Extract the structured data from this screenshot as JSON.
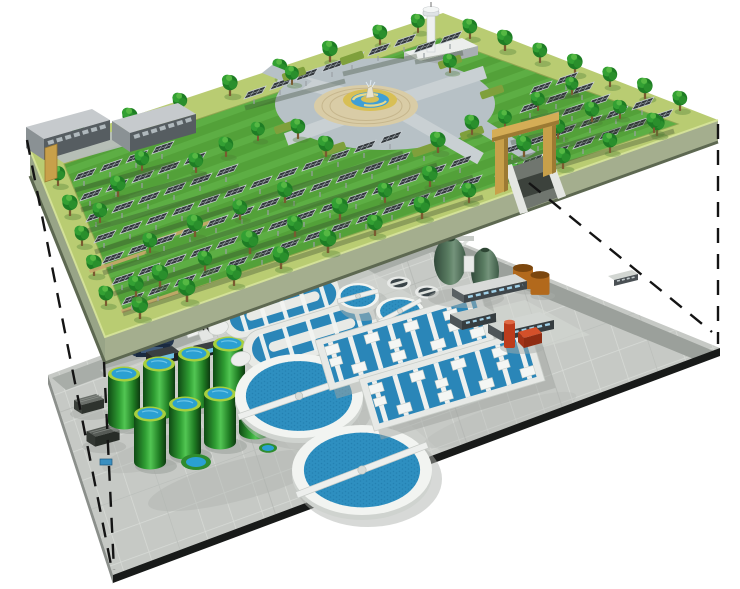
{
  "meta": {
    "description": "Cutaway concept illustration: landscaped solar park deck built above an underground wastewater treatment plant, levels linked by dashed projection lines",
    "width": 740,
    "height": 589
  },
  "palette": {
    "background": "#ffffff",
    "lawn": "#53a139",
    "lawn_stripe": "#66b84b",
    "walkway_band": "#b9cc72",
    "deck_side": "#9aa589",
    "pond_ring": "#b7c1c6",
    "plaza_paving": "#d9cca6",
    "fountain_gold": "#d8bf55",
    "fountain_water": "#3f9fd6",
    "panel_dark": "#34393d",
    "panel_grid": "#c9d0d5",
    "tree_green": "#1e7d24",
    "gate_tan": "#c8a04a",
    "plant_paving": "#c6c9c5",
    "road_gray": "#9ba09b",
    "deck_edge_dark": "#181a19",
    "clarifier_white": "#f2f4f1",
    "process_water": "#2e8fc0",
    "basin_water": "#2a86b8",
    "tank_green": "#2f9e33",
    "tank_rim": "#a6cf3e",
    "digester_green": "#5a7d62",
    "silo_orange": "#b2691c",
    "pump_red": "#d4502a",
    "equipment_navy": "#24364e",
    "projection_line": "#141414"
  },
  "upper": {
    "label": "ground-level-solar-park",
    "solar_rows": [
      [
        132,
        310,
        14
      ],
      [
        122,
        290,
        14
      ],
      [
        112,
        269,
        13
      ],
      [
        104,
        248,
        12
      ],
      [
        96,
        227,
        6
      ],
      [
        90,
        206,
        5
      ],
      [
        84,
        186,
        4
      ],
      [
        254,
        104,
        4
      ],
      [
        352,
        70,
        3
      ],
      [
        424,
        58,
        2
      ],
      [
        505,
        181,
        7
      ],
      [
        512,
        160,
        6
      ],
      [
        520,
        139,
        4
      ],
      [
        530,
        118,
        3
      ],
      [
        540,
        99,
        2
      ]
    ],
    "trees_back": [
      [
        80,
        145,
        0.9
      ],
      [
        130,
        128,
        0.95
      ],
      [
        180,
        112,
        0.9
      ],
      [
        230,
        95,
        0.95
      ],
      [
        280,
        78,
        0.9
      ],
      [
        330,
        61,
        0.95
      ],
      [
        380,
        44,
        0.9
      ],
      [
        418,
        32,
        0.85
      ],
      [
        470,
        38,
        0.9
      ],
      [
        505,
        50,
        0.95
      ],
      [
        540,
        62,
        0.9
      ],
      [
        575,
        74,
        0.95
      ],
      [
        610,
        86,
        0.9
      ],
      [
        645,
        98,
        0.95
      ],
      [
        680,
        110,
        0.9
      ],
      [
        58,
        185,
        0.9
      ],
      [
        70,
        215,
        0.95
      ],
      [
        82,
        245,
        0.9
      ],
      [
        94,
        275,
        0.95
      ],
      [
        106,
        305,
        0.9
      ]
    ],
    "trees": [
      [
        140,
        318,
        1
      ],
      [
        187,
        301,
        1.05
      ],
      [
        234,
        285,
        0.95
      ],
      [
        281,
        268,
        1
      ],
      [
        328,
        252,
        1.05
      ],
      [
        375,
        235,
        0.95
      ],
      [
        422,
        218,
        1
      ],
      [
        469,
        202,
        0.9
      ],
      [
        516,
        185,
        1
      ],
      [
        563,
        168,
        0.95
      ],
      [
        610,
        152,
        0.9
      ],
      [
        657,
        135,
        0.95
      ],
      [
        160,
        286,
        1
      ],
      [
        205,
        270,
        0.9
      ],
      [
        250,
        253,
        1.05
      ],
      [
        295,
        236,
        0.95
      ],
      [
        340,
        219,
        1
      ],
      [
        385,
        202,
        0.9
      ],
      [
        430,
        186,
        0.95
      ],
      [
        150,
        252,
        0.9
      ],
      [
        195,
        236,
        1
      ],
      [
        240,
        219,
        0.9
      ],
      [
        285,
        202,
        0.95
      ],
      [
        136,
        296,
        0.95
      ],
      [
        100,
        222,
        0.9
      ],
      [
        118,
        196,
        0.95
      ],
      [
        142,
        170,
        0.9
      ],
      [
        226,
        156,
        0.9
      ],
      [
        258,
        140,
        0.85
      ],
      [
        196,
        172,
        0.9
      ],
      [
        298,
        138,
        0.9
      ],
      [
        326,
        156,
        0.95
      ],
      [
        438,
        152,
        0.95
      ],
      [
        472,
        134,
        0.9
      ],
      [
        292,
        84,
        0.85
      ],
      [
        450,
        72,
        0.85
      ],
      [
        524,
        156,
        0.95
      ],
      [
        558,
        138,
        0.9
      ],
      [
        592,
        121,
        0.9
      ],
      [
        505,
        128,
        0.85
      ],
      [
        538,
        110,
        0.85
      ],
      [
        572,
        94,
        0.8
      ],
      [
        620,
        118,
        0.85
      ],
      [
        654,
        132,
        0.9
      ]
    ],
    "hedges": [
      [
        472,
        133
      ],
      [
        424,
        150
      ],
      [
        334,
        149
      ],
      [
        286,
        127
      ],
      [
        294,
        74
      ],
      [
        352,
        58
      ],
      [
        450,
        62
      ],
      [
        492,
        92
      ]
    ],
    "terraces": [
      [
        150,
        302
      ],
      [
        118,
        262
      ],
      [
        182,
        232
      ]
    ]
  },
  "lower": {
    "label": "underground-treatment-plant",
    "green_tanks": [
      [
        124,
        424
      ],
      [
        159,
        414
      ],
      [
        194,
        404
      ],
      [
        229,
        394
      ],
      [
        150,
        464
      ],
      [
        185,
        454
      ],
      [
        220,
        444
      ],
      [
        255,
        434
      ]
    ],
    "pools": [
      [
        196,
        462,
        1
      ],
      [
        268,
        448,
        0.6
      ]
    ],
    "ditches": [
      {
        "cx": 283,
        "cy": 306,
        "len": 128,
        "wid": 38,
        "angle": -17
      },
      {
        "cx": 312,
        "cy": 335,
        "len": 142,
        "wid": 42,
        "angle": -17
      }
    ],
    "clarifiers": [
      {
        "cx": 299,
        "cy": 396,
        "rx": 64,
        "ry": 42,
        "bridge": -19
      },
      {
        "cx": 362,
        "cy": 470,
        "rx": 70,
        "ry": 45,
        "bridge": -21
      },
      {
        "cx": 358,
        "cy": 296,
        "rx": 21,
        "ry": 13,
        "bridge": -15
      },
      {
        "cx": 400,
        "cy": 311,
        "rx": 24,
        "ry": 14,
        "bridge": -28
      }
    ],
    "basins": [
      {
        "cx": 405,
        "cy": 341,
        "len": 172,
        "wid": 52,
        "angle": -16.5,
        "lanes": 8
      },
      {
        "cx": 452,
        "cy": 380,
        "len": 178,
        "wid": 54,
        "angle": -16.5,
        "lanes": 8
      }
    ]
  },
  "projection_lines": [
    [
      27,
      140,
      112,
      570
    ],
    [
      104,
      362,
      114,
      570
    ],
    [
      718,
      124,
      718,
      344
    ],
    [
      529,
      183,
      712,
      332
    ]
  ],
  "components": {
    "upper_level": [
      "solar-panel-arrays",
      "trees",
      "central-fountain-plaza",
      "ring-pond",
      "perimeter-walkway",
      "service-buildings",
      "observation-tower",
      "entrance-gate"
    ],
    "lower_level": [
      "oxidation-ditches",
      "clarifiers",
      "aeration-basins",
      "egg-shaped-digesters",
      "sludge-storage-tanks",
      "storage-silos",
      "pump-station",
      "screening-equipment",
      "service-vehicles"
    ]
  }
}
